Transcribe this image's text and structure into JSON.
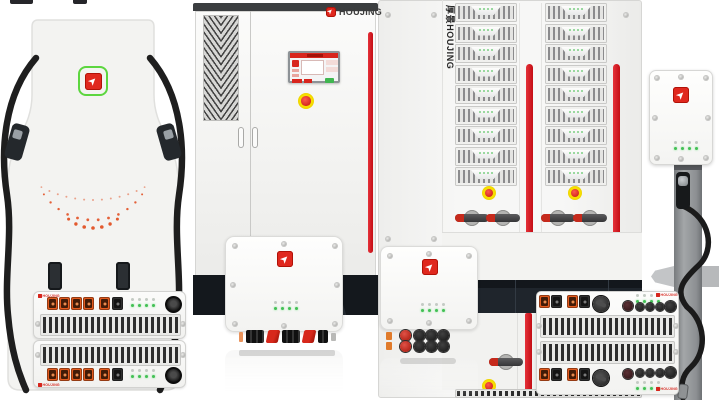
{
  "brand": {
    "name": "HOUJING",
    "vertical_name": "厚景HOUJING"
  },
  "colors": {
    "brand_red": "#e0281e",
    "stripe_red": "#d5161d",
    "logo_ring_green": "#5cd63f",
    "led_green": "#43c055",
    "connector_orange": "#e35b1f",
    "estop_yellow": "#f2d400",
    "estop_red": "#d03124",
    "indicator_dot_orange": "#e25023"
  },
  "products": {
    "dc_fast_charger": {
      "guns": 2,
      "indicator_dot_arcs": 3
    },
    "power_cabinet": {
      "doors": 2,
      "hmi_screen": true,
      "estops": 1
    },
    "rack_system": {
      "columns": 2,
      "modules_per_column": 9,
      "estops": 4,
      "breaker_switches": 5
    },
    "wallbox_charger": {
      "led_count": 8,
      "guns": 1
    },
    "module_stack": {
      "units": 2,
      "orange_connectors_per_unit": 5,
      "black_connectors_per_unit": 1,
      "led_count": 8
    },
    "module_wide": {
      "orange_connectors": 4,
      "black_connectors": 4,
      "round_connectors": 10,
      "led_count": 16
    },
    "inverter_compact": {
      "led_count": 8
    },
    "inverter_round": {
      "led_count": 8
    }
  }
}
